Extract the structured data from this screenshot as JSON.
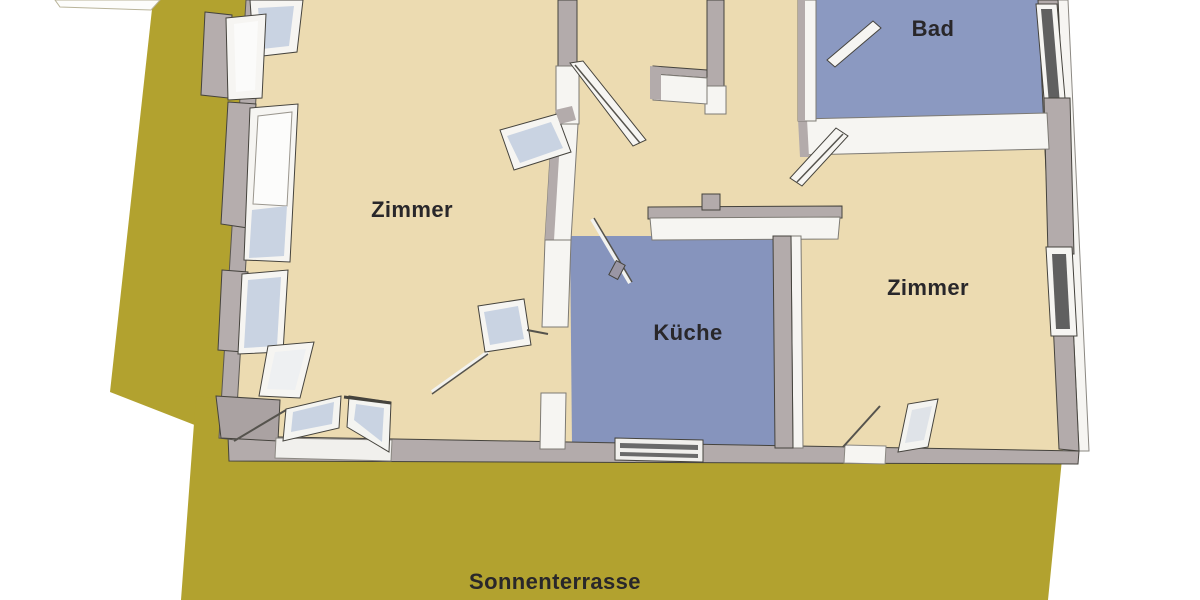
{
  "floorplan": {
    "type": "3d-floor-plan-top-view",
    "labels": {
      "room_left": "Zimmer",
      "kitchen": "Küche",
      "bath": "Bad",
      "room_right": "Zimmer",
      "terrace": "Sonnenterrasse"
    },
    "colors": {
      "background": "#ffffff",
      "terrace": "#b2a22f",
      "room_floor": "#ecdbb1",
      "kitchen_floor": "#8694bd",
      "bath_floor": "#8b99c1",
      "wall_top": "#b3abab",
      "wall_top_light": "#d6d0cc",
      "wall_face": "#f6f5f2",
      "outline": "#45433d",
      "glass": "#c9d3e2",
      "glass_white": "#fbfbfa",
      "dark_window": "#606060",
      "label_text": "#29272a"
    }
  }
}
